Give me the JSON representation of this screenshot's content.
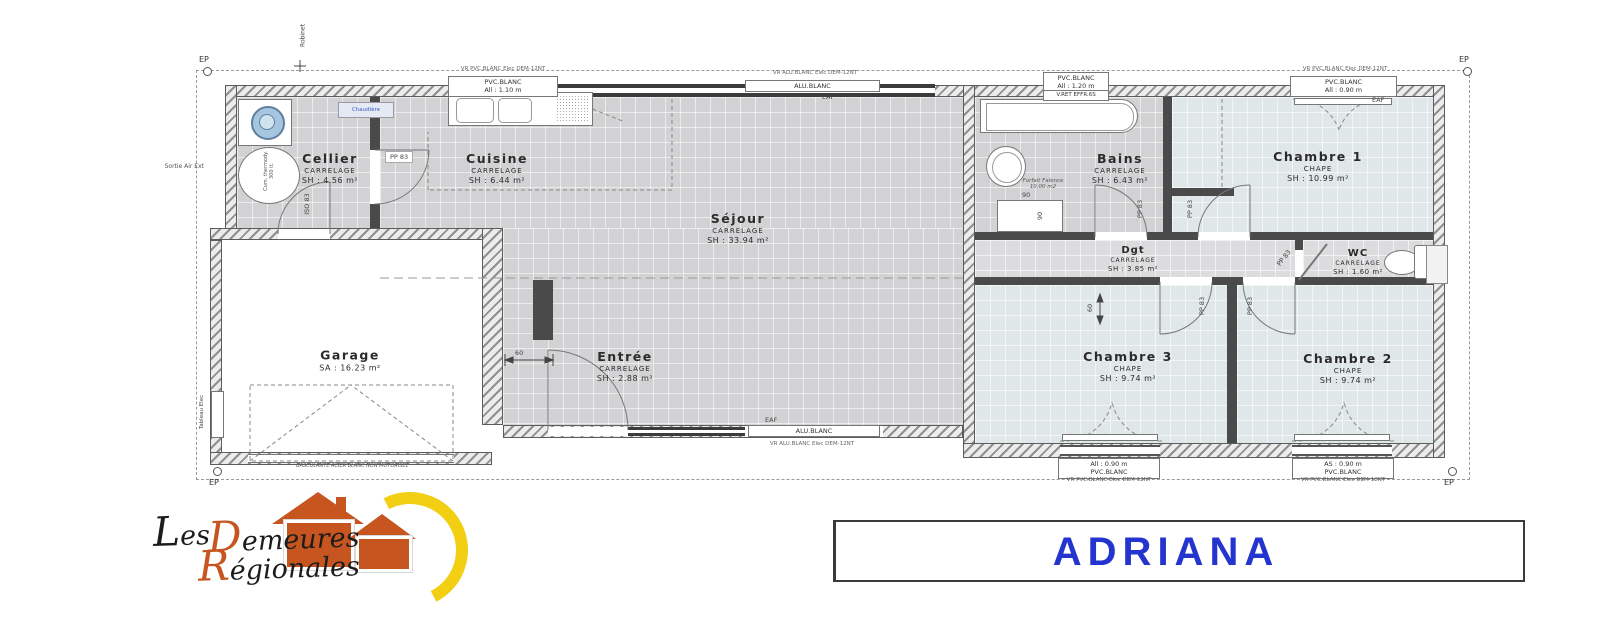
{
  "plan": {
    "project_name": "ADRIANA",
    "brand": {
      "word1": "Les",
      "word2": "Demeures",
      "word3": "Régionales"
    },
    "colors": {
      "accent_blue": "#2434CE",
      "brand_orange": "#C7551F",
      "brand_yellow": "#F2CF13",
      "tile_gray": "#D2D2D4",
      "bedroom_blue": "#DFE7E9"
    },
    "rooms": {
      "cellier": {
        "name": "Cellier",
        "finish": "CARRELAGE",
        "area": "SH : 4.56 m²"
      },
      "cuisine": {
        "name": "Cuisine",
        "finish": "CARRELAGE",
        "area": "SH : 6.44 m²"
      },
      "sejour": {
        "name": "Séjour",
        "finish": "CARRELAGE",
        "area": "SH : 33.94 m²"
      },
      "entree": {
        "name": "Entrée",
        "finish": "CARRELAGE",
        "area": "SH : 2.88 m²"
      },
      "garage": {
        "name": "Garage",
        "area": "SA : 16.23 m²"
      },
      "bains": {
        "name": "Bains",
        "finish": "CARRELAGE",
        "area": "SH : 6.43 m²"
      },
      "dgt": {
        "name": "Dgt",
        "finish": "CARRELAGE",
        "area": "SH : 3.85 m²"
      },
      "wc": {
        "name": "WC",
        "finish": "CARRELAGE",
        "area": "SH : 1.60 m²"
      },
      "chambre1": {
        "name": "Chambre 1",
        "finish": "CHAPE",
        "area": "SH : 10.99 m²"
      },
      "chambre2": {
        "name": "Chambre 2",
        "finish": "CHAPE",
        "area": "SH : 9.74 m²"
      },
      "chambre3": {
        "name": "Chambre 3",
        "finish": "CHAPE",
        "area": "SH : 9.74 m²"
      }
    },
    "openings": {
      "top_window_kitchen": {
        "vr": "VR PVC.BLANC Elec DEM-12NT",
        "type": "PVC.BLANC",
        "dim": "All : 1.10 m"
      },
      "top_bay_sejour": {
        "vr": "VR ALU.BLANC Elec DEM-12NT",
        "type": "ALU.BLANC"
      },
      "top_window_bains": {
        "type": "PVC.BLANC",
        "dim": "All : 1.20 m",
        "note": "V.RET EFFR.6S"
      },
      "top_window_ch1": {
        "vr": "VR PVC.BLANC Elec DEM-12NT",
        "type": "PVC.BLANC",
        "dim": "All : 0.90 m"
      },
      "bottom_bay_sejour": {
        "type": "ALU.BLANC",
        "vr": "VR ALU.BLANC Elec DEM-12NT"
      },
      "bottom_window_ch3": {
        "dim": "All : 0.90 m",
        "type": "PVC.BLANC",
        "vr": "VR PVC.BLANC Elec DEM-12NT"
      },
      "bottom_window_ch2": {
        "dim": "AS : 0.90 m",
        "type": "PVC.BLANC",
        "vr": "VR PVC.BLANC Elec DEM-12NT"
      },
      "door_pp83": "PP 83",
      "door_iso83": "ISO 83",
      "garage_door_note": "BASCULANTE ACIER BLANC NON MOTORISEE"
    },
    "annotations": {
      "ep": "EP",
      "robinet": "Robinet",
      "sortie_air": "Sortie Air Ext",
      "tableau_elec": "Tableau Elec",
      "chaudiere": "Chaudière",
      "cumulus_line1": "Cum. thermody.",
      "cumulus_line2": "300 lt.",
      "forfait_line1": "Forfait Faïence",
      "forfait_line2": "10.00 m2",
      "shower_width": "90",
      "shower_depth": "90",
      "dim_60": "60",
      "eaf": "EAF"
    }
  }
}
